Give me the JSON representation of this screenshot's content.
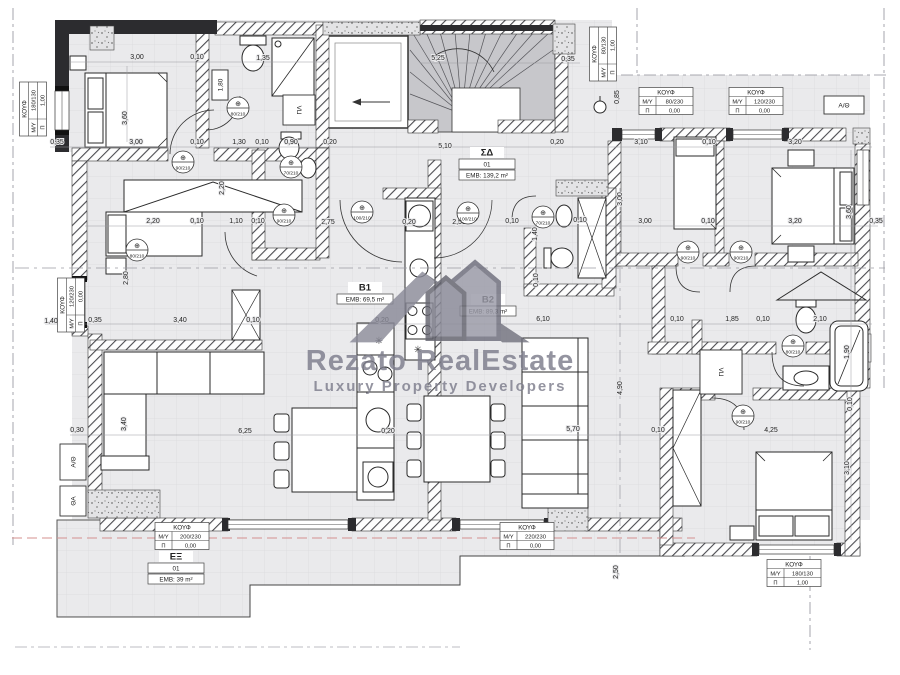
{
  "watermark": {
    "brand": "Rezato RealEstate",
    "tagline": "Luxury Property Developers",
    "color": "#7d7d8c"
  },
  "colors": {
    "floor": "#eaeaec",
    "terrace": "#ededef",
    "wall_dark": "#2c2c2f",
    "stairs_fill": "#c7c7cb",
    "hatch_line": "#4a4a4f",
    "boundary": "#8f8f98",
    "accent_pink": "#d4908f",
    "text": "#222222"
  },
  "rooms": [
    {
      "name": "ΣΔ",
      "num": "01",
      "emb": "EMB: 139,2 m²",
      "cx": 487,
      "cy": 147
    },
    {
      "name": "B1",
      "emb": "EMB: 69,5 m²",
      "cx": 365,
      "cy": 282
    },
    {
      "name": "B2",
      "emb": "EMB: 89,3 m²",
      "cx": 488,
      "cy": 294
    },
    {
      "name": "ΕΞ",
      "num": "01",
      "emb": "EMB: 39 m²",
      "cx": 176,
      "cy": 551
    }
  ],
  "openings_labels": {
    "title": "ΚΟΥΦ",
    "c1": "Μ/Υ",
    "c2": "Π"
  },
  "openings": [
    {
      "cx": 33,
      "cy": 109,
      "v": 1,
      "my": "180/130",
      "p": "1,00"
    },
    {
      "cx": 71,
      "cy": 305,
      "v": 1,
      "my": "120/230",
      "p": "0,00"
    },
    {
      "cx": 603,
      "cy": 54,
      "v": 1,
      "my": "80/130",
      "p": "1,00"
    },
    {
      "cx": 666,
      "cy": 101,
      "v": 0,
      "my": "80/230",
      "p": "0,00"
    },
    {
      "cx": 756,
      "cy": 101,
      "v": 0,
      "my": "120/230",
      "p": "0,00"
    },
    {
      "cx": 182,
      "cy": 536,
      "v": 0,
      "my": "200/230",
      "p": "0,00"
    },
    {
      "cx": 527,
      "cy": 536,
      "v": 0,
      "my": "220/230",
      "p": "0,00"
    },
    {
      "cx": 794,
      "cy": 573,
      "v": 0,
      "my": "180/130",
      "p": "1,00"
    }
  ],
  "doors": [
    {
      "x": 183,
      "y": 162,
      "t": "90/210"
    },
    {
      "x": 238,
      "y": 108,
      "t": "80/210"
    },
    {
      "x": 137,
      "y": 250,
      "t": "80/210"
    },
    {
      "x": 284,
      "y": 215,
      "t": "90/210"
    },
    {
      "x": 291,
      "y": 167,
      "t": "70/210"
    },
    {
      "x": 362,
      "y": 212,
      "t": "100/210"
    },
    {
      "x": 468,
      "y": 213,
      "t": "100/210"
    },
    {
      "x": 543,
      "y": 217,
      "t": "70/210"
    },
    {
      "x": 688,
      "y": 252,
      "t": "90/210"
    },
    {
      "x": 741,
      "y": 252,
      "t": "90/210"
    },
    {
      "x": 793,
      "y": 346,
      "t": "80/210"
    },
    {
      "x": 743,
      "y": 416,
      "t": "90/210"
    }
  ],
  "equipment": [
    {
      "t": "ΠΛ",
      "x": 299,
      "y": 110,
      "w": 32,
      "h": 30,
      "r": 1
    },
    {
      "t": "ΠΛ",
      "x": 721,
      "y": 372,
      "w": 42,
      "h": 44,
      "r": 1
    },
    {
      "t": "1,80",
      "x": 220,
      "y": 85,
      "w": 16,
      "h": 30,
      "r": 1
    },
    {
      "t": "Α/Θ",
      "x": 844,
      "y": 105,
      "w": 40,
      "h": 18,
      "r": 0
    },
    {
      "t": "Α/Θ",
      "x": 73,
      "y": 462,
      "w": 26,
      "h": 36,
      "r": 1
    },
    {
      "t": "ΘΑ",
      "x": 73,
      "y": 501,
      "w": 26,
      "h": 30,
      "r": 1
    }
  ],
  "glyphs": [
    {
      "t": "✳",
      "x": 379,
      "y": 344
    },
    {
      "t": "✳",
      "x": 418,
      "y": 353
    }
  ],
  "dimensions": [
    {
      "t": "3,00",
      "x": 137,
      "y": 59
    },
    {
      "t": "0,10",
      "x": 197,
      "y": 59
    },
    {
      "t": "1,35",
      "x": 263,
      "y": 60
    },
    {
      "t": "5,25",
      "x": 438,
      "y": 60
    },
    {
      "t": "0,35",
      "x": 568,
      "y": 61
    },
    {
      "t": "3,60",
      "x": 127,
      "y": 118,
      "r": 1
    },
    {
      "t": "0,85",
      "x": 619,
      "y": 97,
      "r": 1
    },
    {
      "t": "0,35",
      "x": 57,
      "y": 144
    },
    {
      "t": "3,00",
      "x": 136,
      "y": 144
    },
    {
      "t": "0,10",
      "x": 197,
      "y": 144
    },
    {
      "t": "1,30",
      "x": 239,
      "y": 144
    },
    {
      "t": "0,10",
      "x": 262,
      "y": 144
    },
    {
      "t": "0,90",
      "x": 291,
      "y": 144
    },
    {
      "t": "0,20",
      "x": 330,
      "y": 144
    },
    {
      "t": "5,10",
      "x": 445,
      "y": 148
    },
    {
      "t": "0,20",
      "x": 557,
      "y": 144
    },
    {
      "t": "3,10",
      "x": 641,
      "y": 144
    },
    {
      "t": "0,10",
      "x": 709,
      "y": 144
    },
    {
      "t": "3,20",
      "x": 795,
      "y": 144
    },
    {
      "t": "2,20",
      "x": 153,
      "y": 223
    },
    {
      "t": "0,10",
      "x": 197,
      "y": 223
    },
    {
      "t": "1,10",
      "x": 236,
      "y": 223
    },
    {
      "t": "0,10",
      "x": 258,
      "y": 223
    },
    {
      "t": "2,75",
      "x": 328,
      "y": 224
    },
    {
      "t": "0,20",
      "x": 409,
      "y": 224
    },
    {
      "t": "2,58",
      "x": 459,
      "y": 224
    },
    {
      "t": "0,10",
      "x": 512,
      "y": 223
    },
    {
      "t": "1,60",
      "x": 546,
      "y": 222
    },
    {
      "t": "0,10",
      "x": 580,
      "y": 222
    },
    {
      "t": "3,00",
      "x": 645,
      "y": 223
    },
    {
      "t": "0,10",
      "x": 708,
      "y": 223
    },
    {
      "t": "3,20",
      "x": 795,
      "y": 223
    },
    {
      "t": "0,35",
      "x": 876,
      "y": 223
    },
    {
      "t": "2,20",
      "x": 224,
      "y": 188,
      "r": 1
    },
    {
      "t": "3,00",
      "x": 622,
      "y": 199,
      "r": 1
    },
    {
      "t": "3,60",
      "x": 851,
      "y": 212,
      "r": 1
    },
    {
      "t": "1,40",
      "x": 537,
      "y": 234,
      "r": 1
    },
    {
      "t": "2,80",
      "x": 128,
      "y": 278,
      "r": 1
    },
    {
      "t": "0,10",
      "x": 538,
      "y": 280,
      "r": 1
    },
    {
      "t": "1,40",
      "x": 51,
      "y": 323
    },
    {
      "t": "0,35",
      "x": 95,
      "y": 322
    },
    {
      "t": "3,40",
      "x": 180,
      "y": 322
    },
    {
      "t": "0,10",
      "x": 253,
      "y": 322
    },
    {
      "t": "0,20",
      "x": 382,
      "y": 322
    },
    {
      "t": "6,10",
      "x": 543,
      "y": 321
    },
    {
      "t": "0,10",
      "x": 677,
      "y": 321
    },
    {
      "t": "1,85",
      "x": 732,
      "y": 321
    },
    {
      "t": "0,10",
      "x": 763,
      "y": 321
    },
    {
      "t": "2,10",
      "x": 820,
      "y": 321
    },
    {
      "t": "1,90",
      "x": 849,
      "y": 352,
      "r": 1
    },
    {
      "t": "0,30",
      "x": 77,
      "y": 432
    },
    {
      "t": "3,40",
      "x": 126,
      "y": 424,
      "r": 1
    },
    {
      "t": "6,25",
      "x": 245,
      "y": 433
    },
    {
      "t": "0,20",
      "x": 388,
      "y": 433
    },
    {
      "t": "5,70",
      "x": 573,
      "y": 431
    },
    {
      "t": "0,10",
      "x": 658,
      "y": 432
    },
    {
      "t": "4,25",
      "x": 771,
      "y": 432
    },
    {
      "t": "3,10",
      "x": 849,
      "y": 468,
      "r": 1
    },
    {
      "t": "0,10",
      "x": 852,
      "y": 404,
      "r": 1
    },
    {
      "t": "4,90",
      "x": 622,
      "y": 388,
      "r": 1
    },
    {
      "t": "2,50",
      "x": 618,
      "y": 572,
      "r": 1
    }
  ]
}
